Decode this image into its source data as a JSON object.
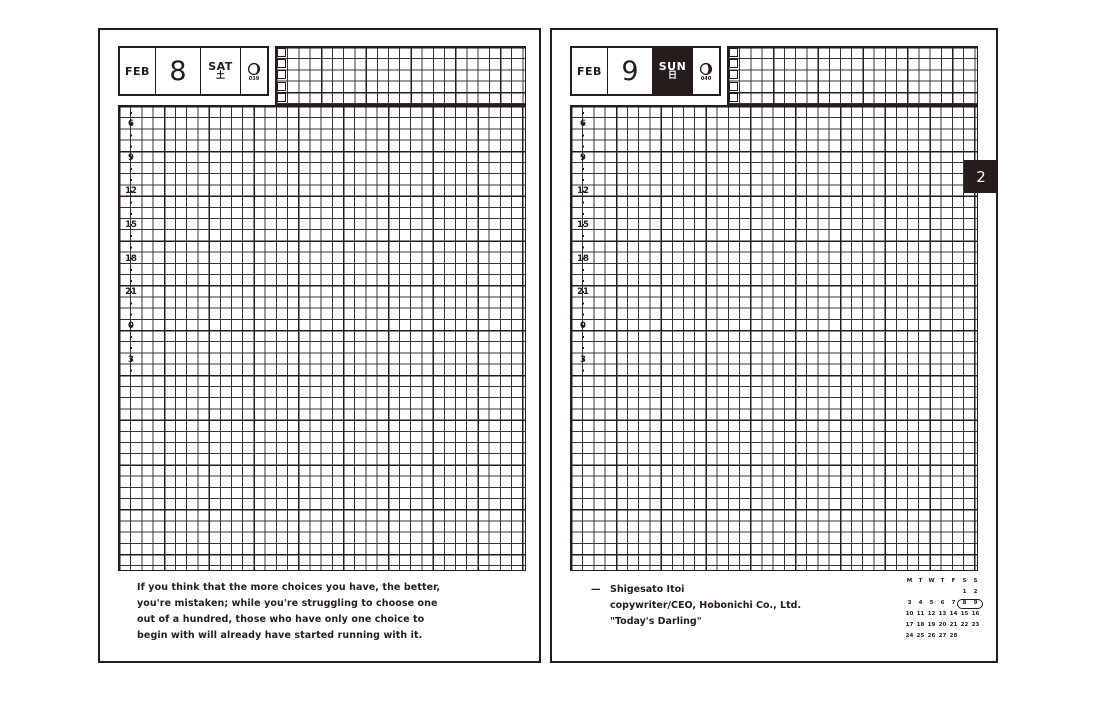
{
  "spread": {
    "ink_color": "#241d1b",
    "month_tab_label": "2"
  },
  "left_page": {
    "header": {
      "month": "FEB",
      "day": "8",
      "weekday": "SAT",
      "weekday_jp": "土",
      "moon_icon": "moon-phase-icon",
      "day_of_year": "039"
    },
    "timeline": {
      "hours": [
        "6",
        "9",
        "12",
        "15",
        "18",
        "21",
        "0",
        "3"
      ]
    },
    "quote_lines": [
      "If you think that the more choices you have, the better,",
      "you're mistaken; while you're struggling to choose one",
      "out of a hundred, those who have only one choice to",
      "begin with will already have started running with it."
    ]
  },
  "right_page": {
    "header": {
      "month": "FEB",
      "day": "9",
      "weekday": "SUN",
      "weekday_jp": "日",
      "moon_icon": "moon-phase-icon",
      "day_of_year": "040"
    },
    "timeline": {
      "hours": [
        "6",
        "9",
        "12",
        "15",
        "18",
        "21",
        "0",
        "3"
      ]
    },
    "attribution": {
      "dash": "—",
      "lines": [
        "Shigesato Itoi",
        "copywriter/CEO, Hobonichi Co., Ltd.",
        "\"Today's Darling\""
      ]
    },
    "mini_calendar": {
      "weekday_headers": [
        "M",
        "T",
        "W",
        "T",
        "F",
        "S",
        "S"
      ],
      "weeks": [
        [
          "",
          "",
          "",
          "",
          "",
          "1",
          "2"
        ],
        [
          "3",
          "4",
          "5",
          "6",
          "7",
          "8",
          "9"
        ],
        [
          "10",
          "11",
          "12",
          "13",
          "14",
          "15",
          "16"
        ],
        [
          "17",
          "18",
          "19",
          "20",
          "21",
          "22",
          "23"
        ],
        [
          "24",
          "25",
          "26",
          "27",
          "28",
          "",
          ""
        ]
      ],
      "highlighted_days": "8 9"
    }
  }
}
